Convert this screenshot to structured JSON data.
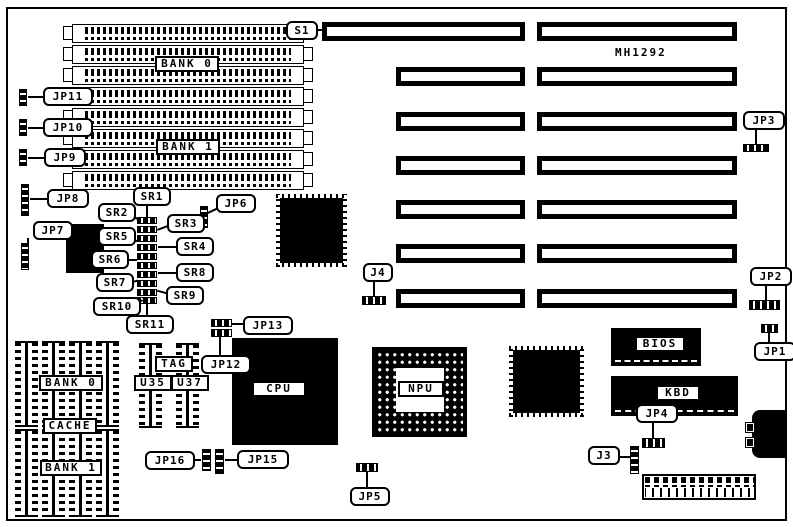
{
  "board": {
    "model": "MH1292"
  },
  "memory_banks": {
    "bank0": "BANK 0",
    "bank1": "BANK 1"
  },
  "cache_area": {
    "bank0": "BANK 0",
    "cache": "CACHE",
    "bank1": "BANK 1",
    "tag": "TAG",
    "u35": "U35",
    "u37": "U37"
  },
  "chips": {
    "cpu": "CPU",
    "npu": "NPU",
    "bios": "BIOS",
    "kbd": "KBD"
  },
  "switch": {
    "s1": "S1"
  },
  "jumpers": {
    "jp1": "JP1",
    "jp2": "JP2",
    "jp3": "JP3",
    "jp4": "JP4",
    "jp5": "JP5",
    "jp6": "JP6",
    "jp7": "JP7",
    "jp8": "JP8",
    "jp9": "JP9",
    "jp10": "JP10",
    "jp11": "JP11",
    "jp12": "JP12",
    "jp13": "JP13",
    "jp15": "JP15",
    "jp16": "JP16",
    "j3": "J3",
    "j4": "J4"
  },
  "resistors": {
    "sr1": "SR1",
    "sr2": "SR2",
    "sr3": "SR3",
    "sr4": "SR4",
    "sr5": "SR5",
    "sr6": "SR6",
    "sr7": "SR7",
    "sr8": "SR8",
    "sr9": "SR9",
    "sr10": "SR10",
    "sr11": "SR11"
  }
}
